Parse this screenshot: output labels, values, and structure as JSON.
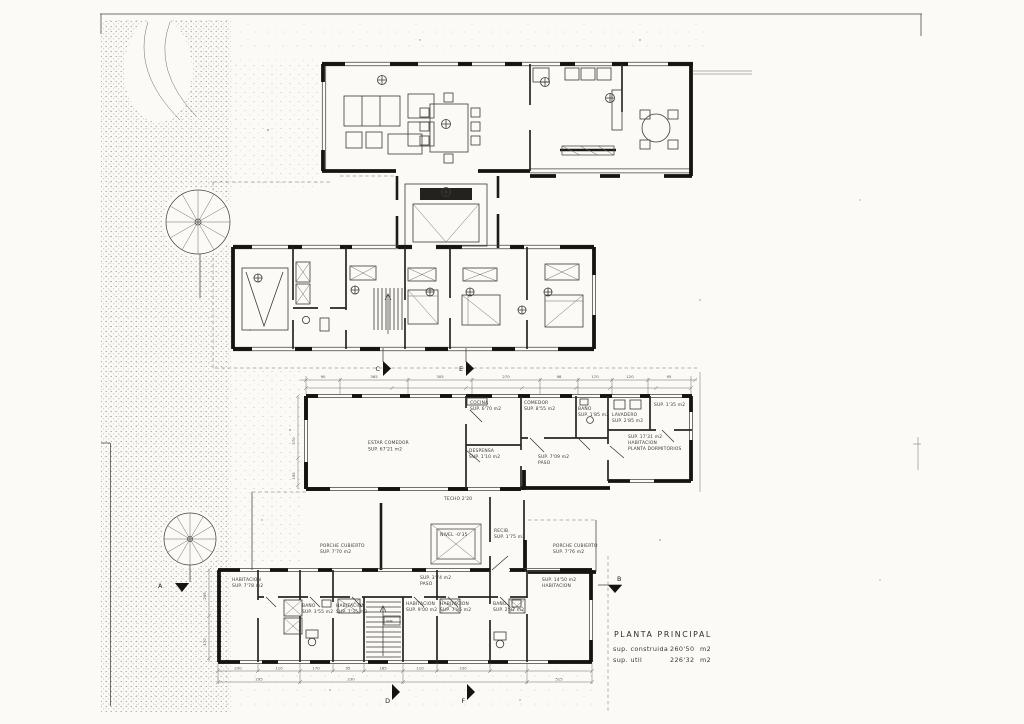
{
  "sheet": {
    "title": "PLANTA PRINCIPAL",
    "areas": {
      "construida_label": "sup. construida",
      "construida_value": "260'50",
      "construida_unit": "m2",
      "util_label": "sup. util",
      "util_value": "226'32",
      "util_unit": "m2"
    }
  },
  "markers": {
    "a": "A",
    "b": "B",
    "c": "C",
    "d": "D",
    "e": "E",
    "f": "F"
  },
  "middle_plan": {
    "estar": {
      "name": "ESTAR COMEDOR",
      "area": "SUP. 67'21 m2"
    },
    "cocina": {
      "name": "COCINA",
      "area": "SUP. 6'70 m2"
    },
    "comedor": {
      "name": "COMEDOR",
      "area": "SUP. 8'55 m2"
    },
    "bano": {
      "name": "BAÑO",
      "area": "SUP. 1'85 m2"
    },
    "despensa": {
      "name": "DESPENSA",
      "area": "SUP. 1'10 m2"
    },
    "paso": {
      "name": "PASO",
      "area": "SUP. 7'09 m2"
    },
    "lavadero": {
      "name": "LAVADERO",
      "area": "SUP. 2'85 m2"
    },
    "aseo": {
      "area": "SUP. 1'35 m2"
    },
    "habitacion": {
      "area": "SUP. 17'31 m2",
      "name": "HABITACION",
      "extra": "PLANTA DORMITORIOS"
    },
    "techo": "TECHO 2'20",
    "dims_top": [
      "90",
      "365",
      "305",
      "270",
      "98",
      "170",
      "120",
      "95"
    ],
    "dims_left": [
      "570",
      "195"
    ]
  },
  "connector": {
    "porche_izq": {
      "name": "PORCHE CUBIERTO",
      "area": "SUP. 7'70 m2"
    },
    "nivel": "NIVEL -0'35",
    "recibidor": {
      "name": "RECIB.",
      "area": "SUP. 1'75 m2"
    },
    "porche_der": {
      "name": "PORCHE CUBIERTO",
      "area": "SUP. 7'76 m2"
    }
  },
  "lower_plan": {
    "habitacion_1": {
      "name": "HABITACION",
      "area": "SUP. 7'78 m2"
    },
    "bano_1": {
      "name": "BAÑO",
      "area": "SUP. 3'55 m2"
    },
    "habitacion_2": {
      "name": "HABITACION",
      "area": "SUP. 7'35 m2"
    },
    "habitacion_3": {
      "name": "HABITACION",
      "area": "SUP. 9'00 m2"
    },
    "habitacion_4": {
      "name": "HABITACION",
      "area": "SUP. 7'85 m2"
    },
    "bano_2": {
      "name": "BAÑO",
      "area": "SUP. 2'92 m2"
    },
    "habitacion_5": {
      "area": "SUP. 14'50 m2",
      "name": "HABITACION"
    },
    "paso": {
      "area": "SUP. 3'74 m2",
      "name": "PASO"
    },
    "stairs": "SUB.",
    "dims_bottom_a": [
      "230",
      "110",
      "170",
      "95",
      "185",
      "110",
      "230"
    ],
    "dims_bottom_b": [
      "295",
      "230",
      "515"
    ],
    "dims_left": [
      "295",
      "170"
    ]
  }
}
